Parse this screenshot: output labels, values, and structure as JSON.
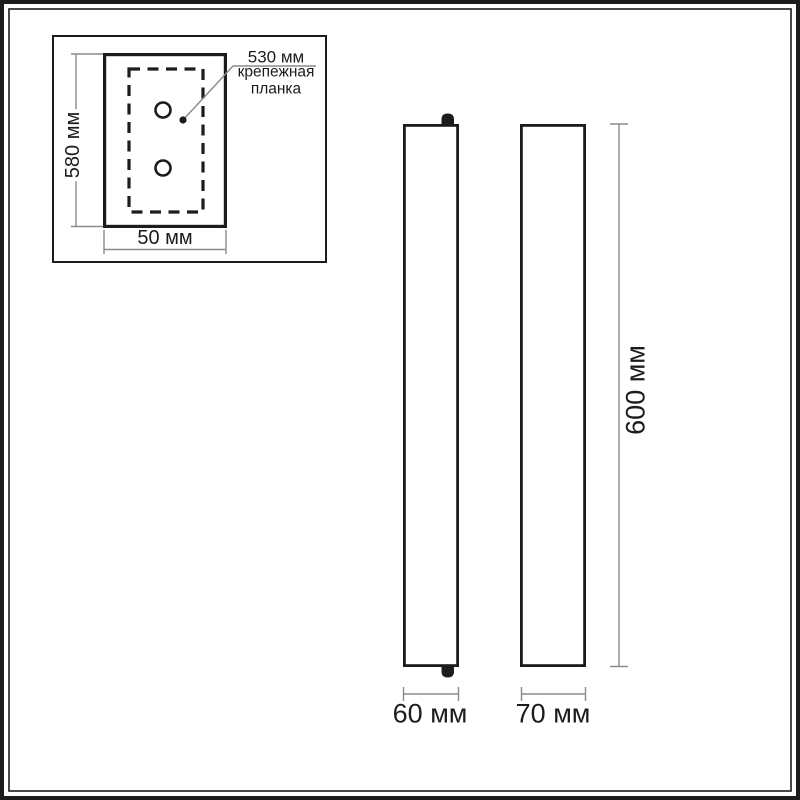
{
  "page": {
    "background": "#ffffff",
    "line_color": "#1c1c1c",
    "dim_line_color": "#8a8a8a",
    "text_color": "#1c1c1c"
  },
  "inset": {
    "plate_height_dim": "580 мм",
    "plate_width_dim": "50 мм",
    "bracket_length_dim": "530 мм",
    "bracket_label_line1": "крепежная",
    "bracket_label_line2": "планка"
  },
  "views": {
    "height_dim": "600 мм",
    "front_width_dim": "60 мм",
    "side_width_dim": "70 мм"
  }
}
